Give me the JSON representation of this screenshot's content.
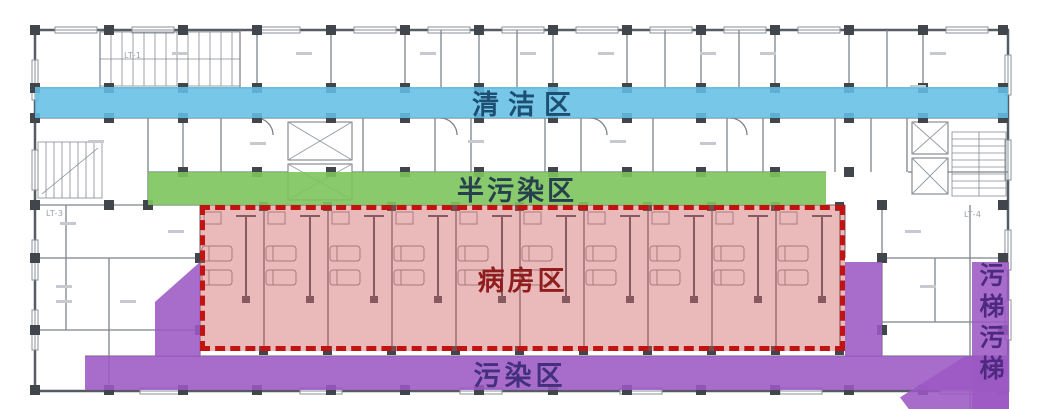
{
  "plan": {
    "background": "#ffffff",
    "wall_color": "#7d848c",
    "column_color": "#41464c"
  },
  "zones": {
    "clean": {
      "label": "清洁区",
      "fill": "#63bfe6",
      "text_color": "#1d4f73"
    },
    "semi_contaminated": {
      "label": "半污染区",
      "fill": "#7cc45c",
      "text_color": "#26404d"
    },
    "ward": {
      "label": "病房区",
      "fill": "#cb5252",
      "border_color": "#c31212",
      "border_style": "dashed",
      "text_color": "#8f1d1d"
    },
    "contaminated": {
      "label": "污染区",
      "fill": "#9c59c4",
      "text_color": "#43307c"
    },
    "dirty_elevator": {
      "label": "污梯",
      "label_repeat": "污梯",
      "text_color": "#4d2a80"
    }
  },
  "stair_labels": {
    "lt1": "LT-1",
    "lt3": "LT-3",
    "lt4": "LT-4"
  }
}
